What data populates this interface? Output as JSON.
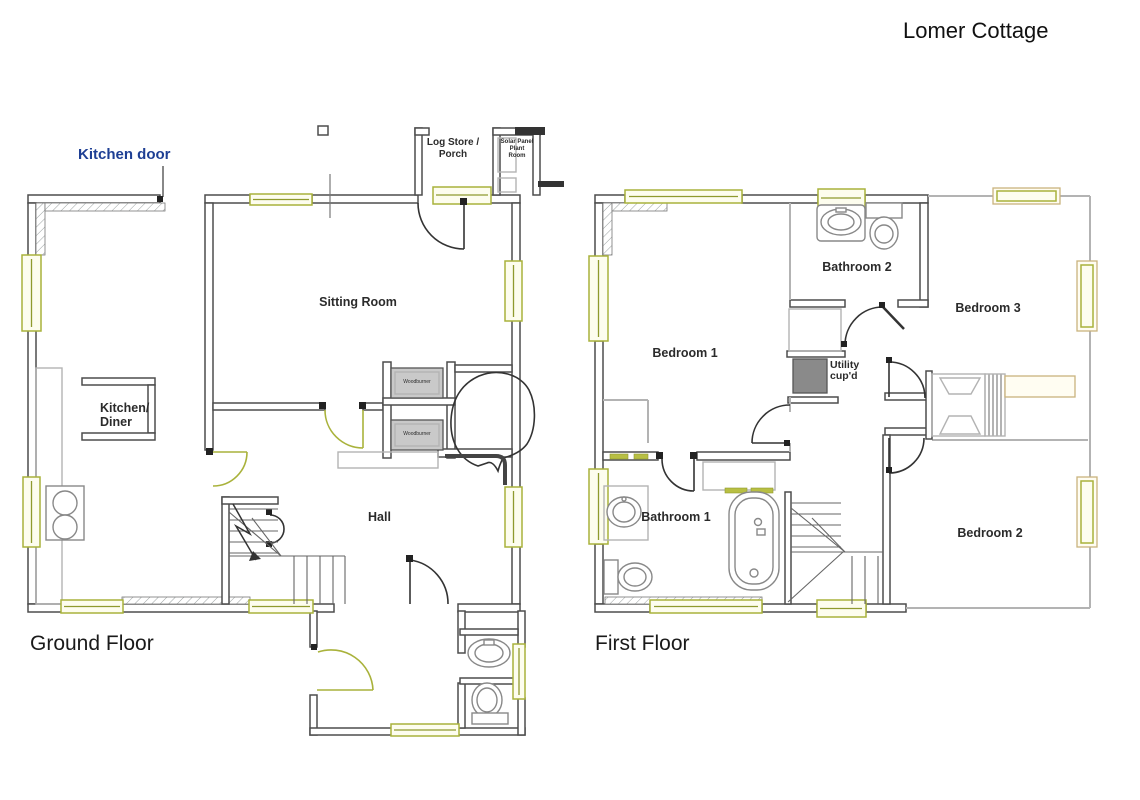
{
  "title": "Lomer Cottage",
  "ground_floor": {
    "caption": "Ground Floor",
    "annotation_kitchen_door": "Kitchen door",
    "rooms": {
      "log_store_porch": "Log Store /\nPorch",
      "solar_room": "Solar Panel\nPlant\nRoom",
      "sitting_room": "Sitting Room",
      "kitchen_diner": "Kitchen/\nDiner",
      "hall": "Hall"
    },
    "fixtures": {
      "woodburner": "Woodburner"
    }
  },
  "first_floor": {
    "caption": "First Floor",
    "rooms": {
      "bedroom1": "Bedroom 1",
      "bedroom2": "Bedroom 2",
      "bedroom3": "Bedroom 3",
      "bathroom1": "Bathroom 1",
      "bathroom2": "Bathroom 2",
      "utility_cupboard": "Utility\ncup'd"
    }
  },
  "colors": {
    "wall_dark": "#4d4d4d",
    "wall_light": "#b3b3b3",
    "window_olive": "#a9b23b",
    "window_frame_tan": "#c9b37e",
    "annotation_blue": "#1e3f94",
    "utility_fill": "#8a8a8a"
  }
}
